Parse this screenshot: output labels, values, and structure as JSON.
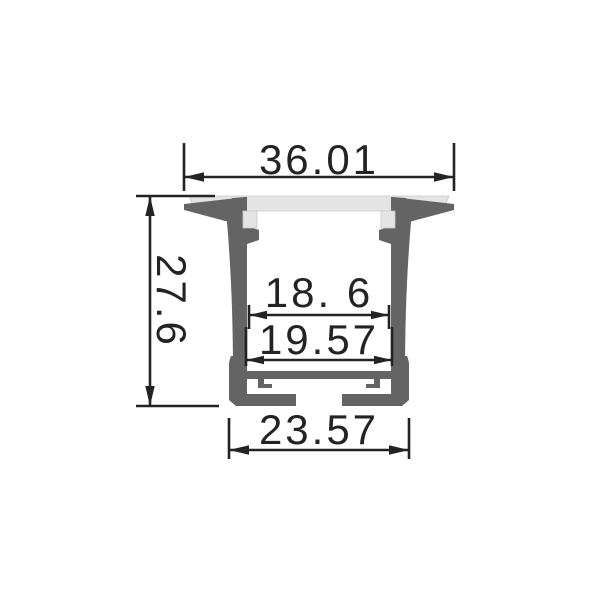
{
  "title": "Recessed LED aluminium profile cross-section technical drawing",
  "drawing": {
    "labels": {
      "overall_width": "36.01",
      "overall_height": "27.6",
      "inner_width": "18. 6",
      "groove_width": "19.57",
      "base_width": "23.57"
    },
    "colors": {
      "profile": "#646464",
      "diffuser": "#e4e4e4",
      "dimension_ink": "#232323",
      "background": "#ffffff"
    }
  }
}
